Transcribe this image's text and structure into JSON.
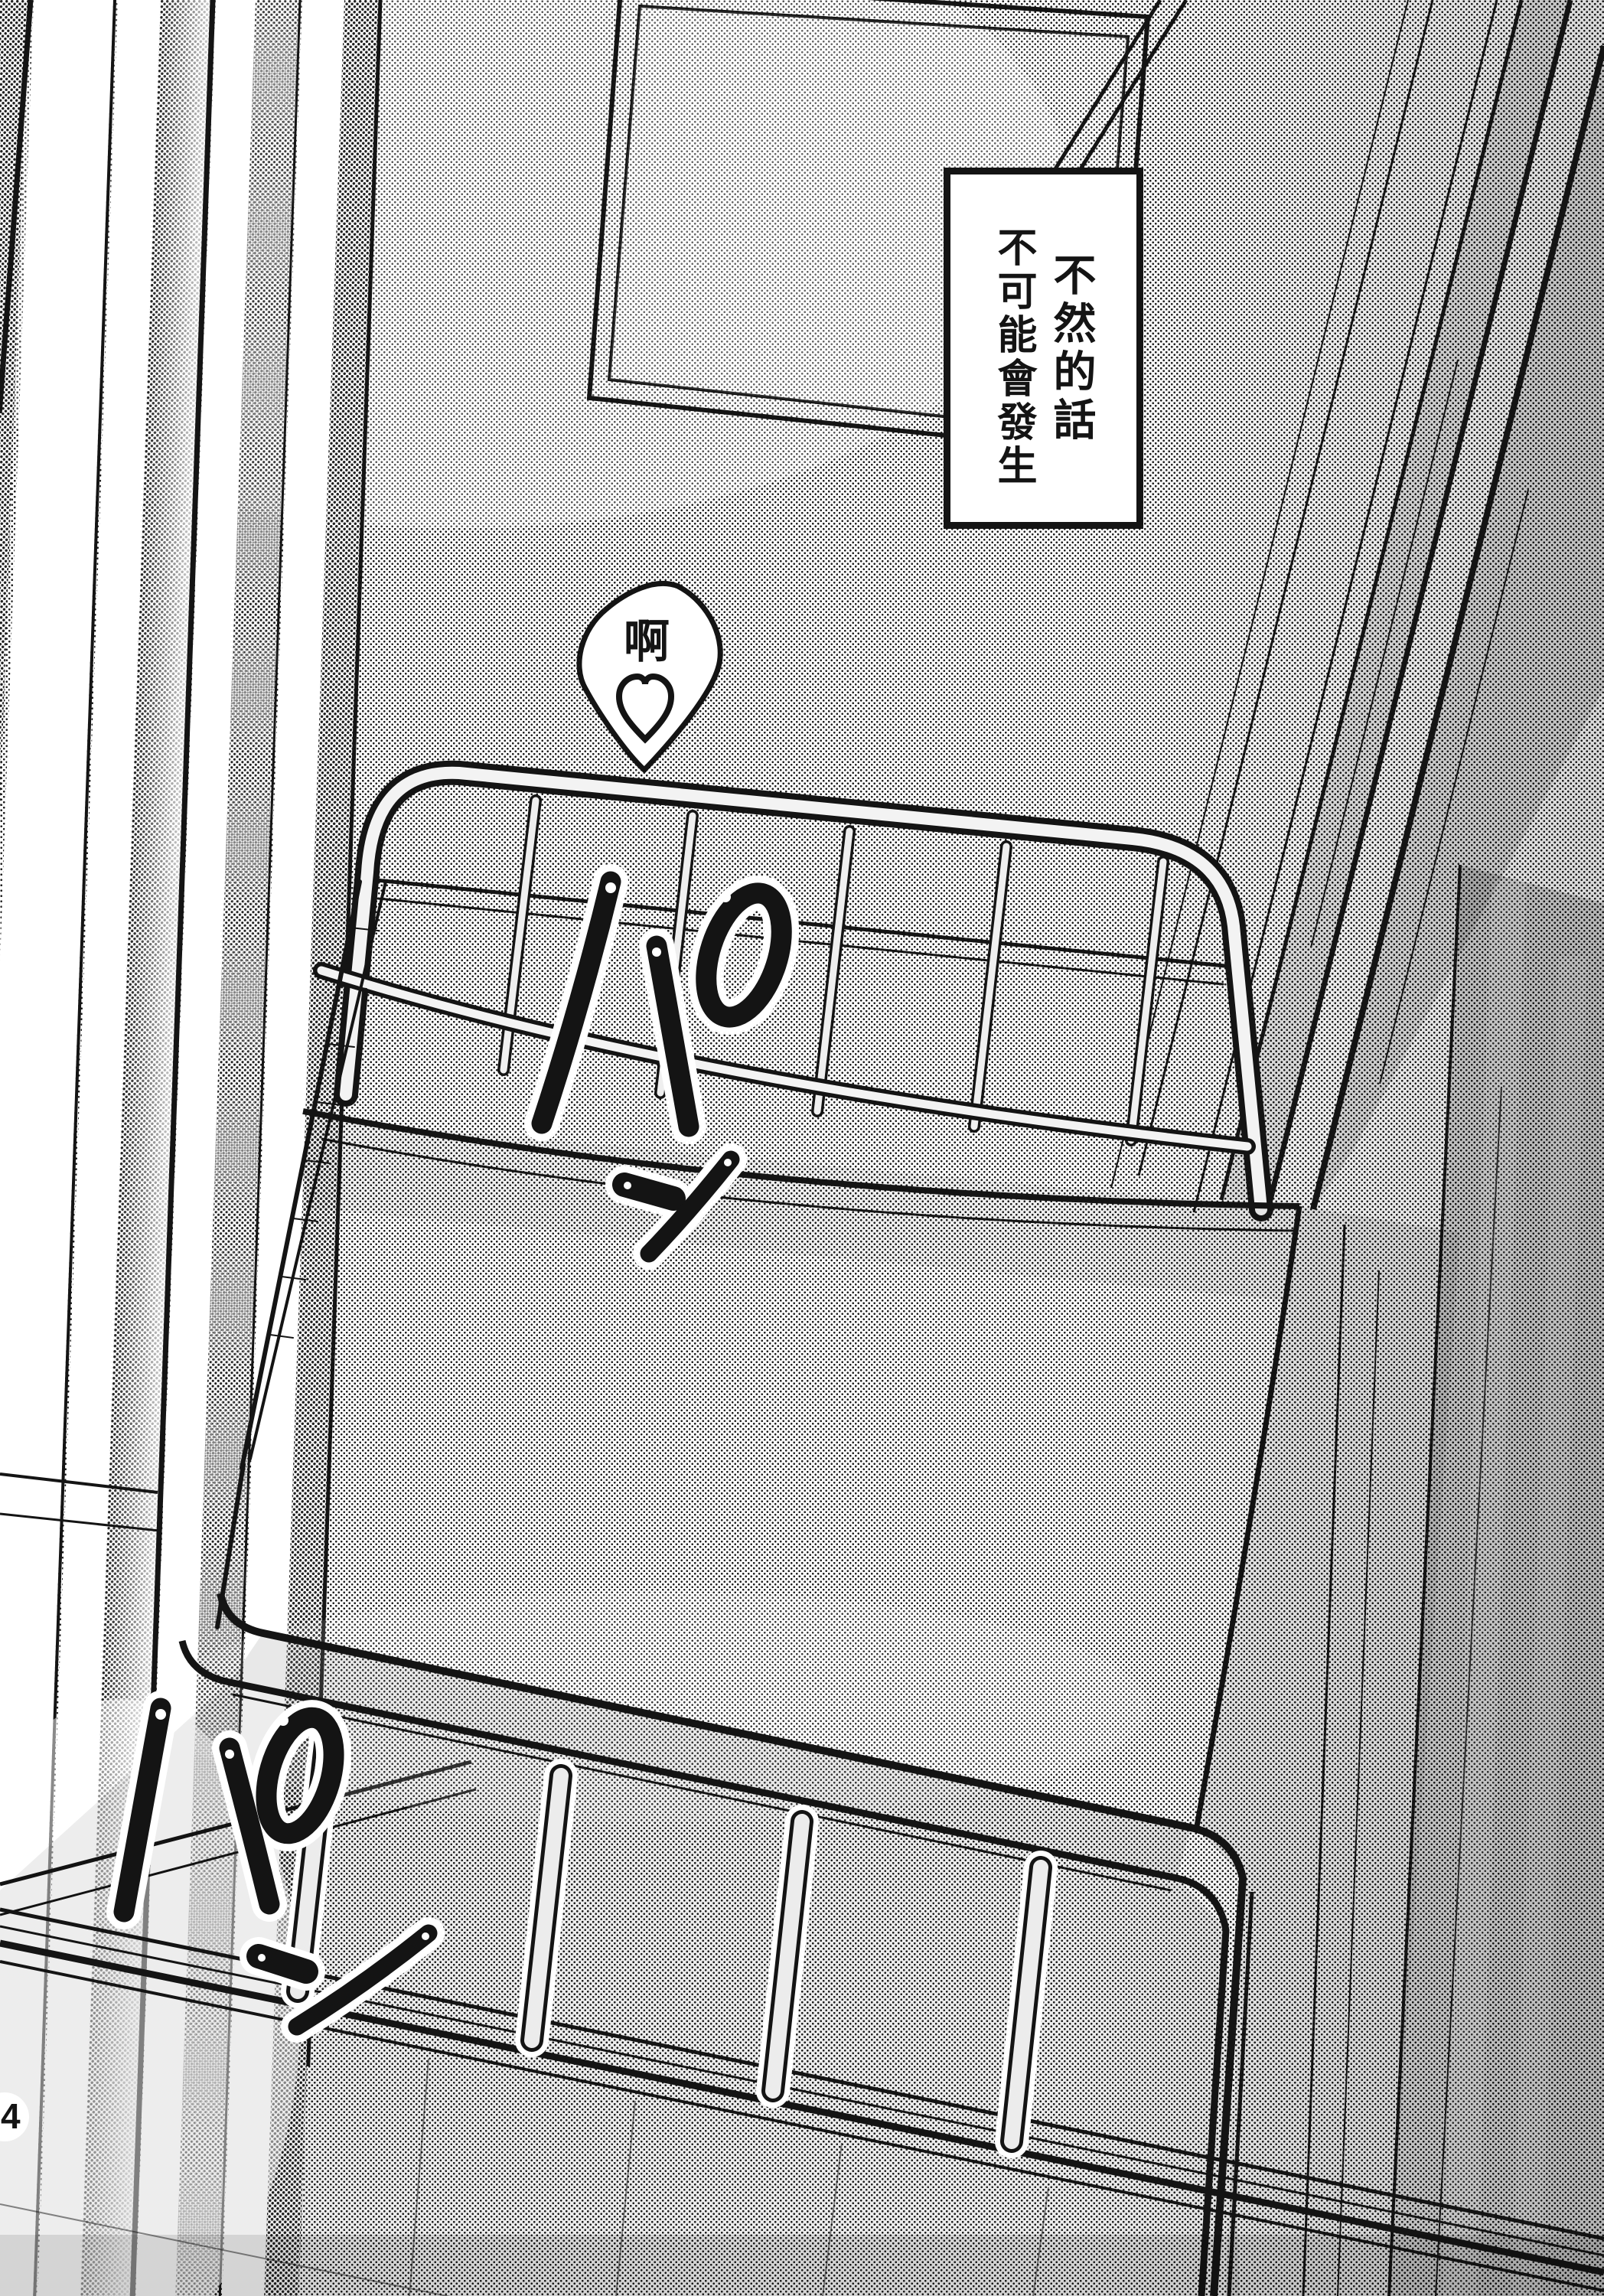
{
  "page": {
    "number": "4",
    "paper_color": "#ffffff",
    "ink_color": "#141414",
    "tone_color": "#c9c9c9"
  },
  "speech_box": {
    "lines": [
      "不然的話",
      "不可能會發生"
    ],
    "full_text": "不然的話不可能會發生"
  },
  "moan_bubble": {
    "text": "啊",
    "heart_icon": "♡"
  },
  "sfx": [
    {
      "text": "パン"
    },
    {
      "text": "パン"
    }
  ]
}
